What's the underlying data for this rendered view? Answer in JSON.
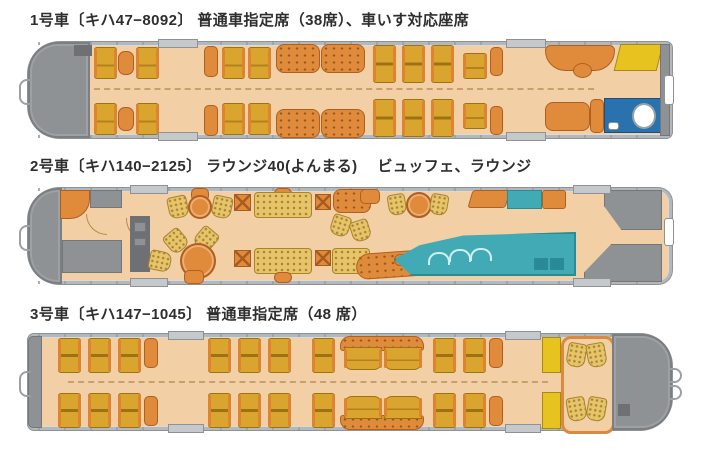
{
  "cars": [
    {
      "label": "1号車〔キハ47−8092〕 普通車指定席（38席）、車いす対応座席"
    },
    {
      "label": "2号車〔キハ140−2125〕 ラウンジ40(よんまる)　 ビュッフェ、ラウンジ"
    },
    {
      "label": "3号車〔キハ147−1045〕 普通車指定席（48 席）"
    }
  ],
  "colors": {
    "floor_tan": "#f2cfa5",
    "seat_gold": "#d9a52e",
    "seat_trim_orange": "#e0832f",
    "bench_orange": "#e08a3c",
    "sofa_gold": "#e7c468",
    "cab_gray": "#8f9295",
    "wall_gray": "#b5b8ba",
    "toilet_blue": "#2a72ae",
    "buffet_teal": "#41aab4",
    "luggage_yellow": "#e7c31f"
  }
}
